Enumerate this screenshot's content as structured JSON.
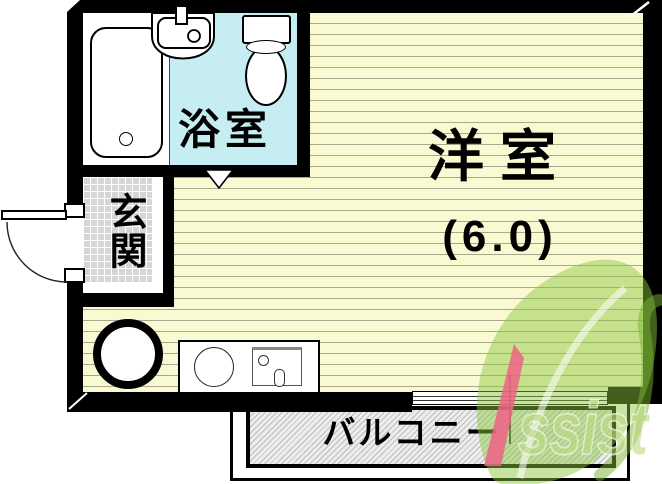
{
  "plan": {
    "rooms": {
      "bathroom": {
        "label": "浴室"
      },
      "main_room": {
        "label": "洋室",
        "size": "(6.0)"
      },
      "entrance": {
        "label": "玄関"
      },
      "balcony": {
        "label": "バルコニー"
      }
    },
    "colors": {
      "wall": "#000000",
      "main_room_floor": "#fafad2",
      "floor_line": "#a8a88e",
      "bathroom_floor": "#c6eef2",
      "entrance_tile": "#d6d6d6",
      "balcony_fill": "#ededed",
      "balcony_hatch_line": "#bcbcbc",
      "watermark_green": "#8dc63f",
      "watermark_pink": "#ee6186"
    },
    "fixtures": {
      "bathtub": "bathtub",
      "washbasin": "washbasin",
      "toilet": "toilet",
      "entrance_door": "entrance-door",
      "bathroom_door_marker": "bathroom-door-marker",
      "round_fixture": "round-fixture",
      "kitchen_counter": "kitchen-counter",
      "kitchen_burner": "burner",
      "kitchen_sink": "kitchen-sink",
      "window": "sliding-window"
    },
    "watermark": {
      "brand": "Assist",
      "visible_tail": "ssist"
    }
  }
}
